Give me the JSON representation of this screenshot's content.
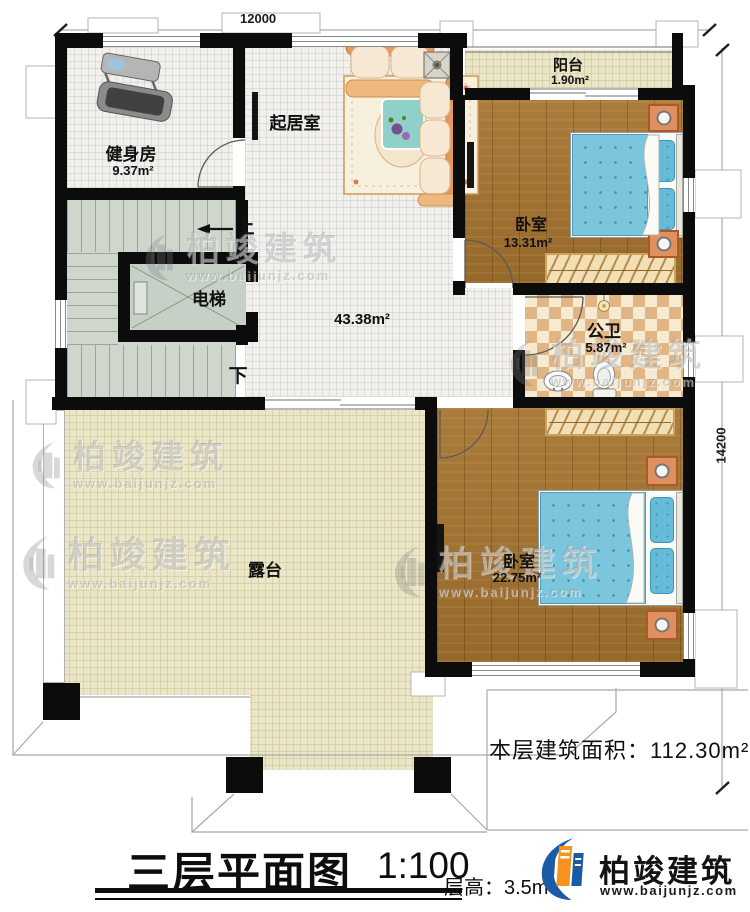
{
  "meta": {
    "title": "三层平面图",
    "scale": "1:100",
    "floor_height": "层高：3.5m",
    "total_area": "本层建筑面积：112.30m²"
  },
  "dimensions": {
    "width_mm": "12000",
    "height_mm": "14200"
  },
  "rooms": {
    "gym": {
      "name": "健身房",
      "area": "9.37m²"
    },
    "living": {
      "name": "起居室"
    },
    "balcony": {
      "name": "阳台",
      "area": "1.90m²"
    },
    "bedroom1": {
      "name": "卧室",
      "area": "13.31m²"
    },
    "bathroom": {
      "name": "公卫",
      "area": "5.87m²"
    },
    "bedroom2": {
      "name": "卧室",
      "area": "22.75m²"
    },
    "elevator": {
      "name": "电梯"
    },
    "hall": {
      "area": "43.38m²"
    },
    "terrace": {
      "name": "露台"
    },
    "stairs": {
      "up": "上",
      "down": "下"
    }
  },
  "brand": {
    "name": "柏竣建筑",
    "website": "www.baijunjz.com"
  },
  "colors": {
    "wall": "#0c0c0c",
    "wood": "#a0722f",
    "tile_beige": "#ebe6c7",
    "stair": "#cfd7cd",
    "checker_tan": "#e2b684",
    "bed_blue": "#7cc6dd",
    "logo_blue": "#1a5aa6",
    "logo_orange": "#f6921e"
  }
}
